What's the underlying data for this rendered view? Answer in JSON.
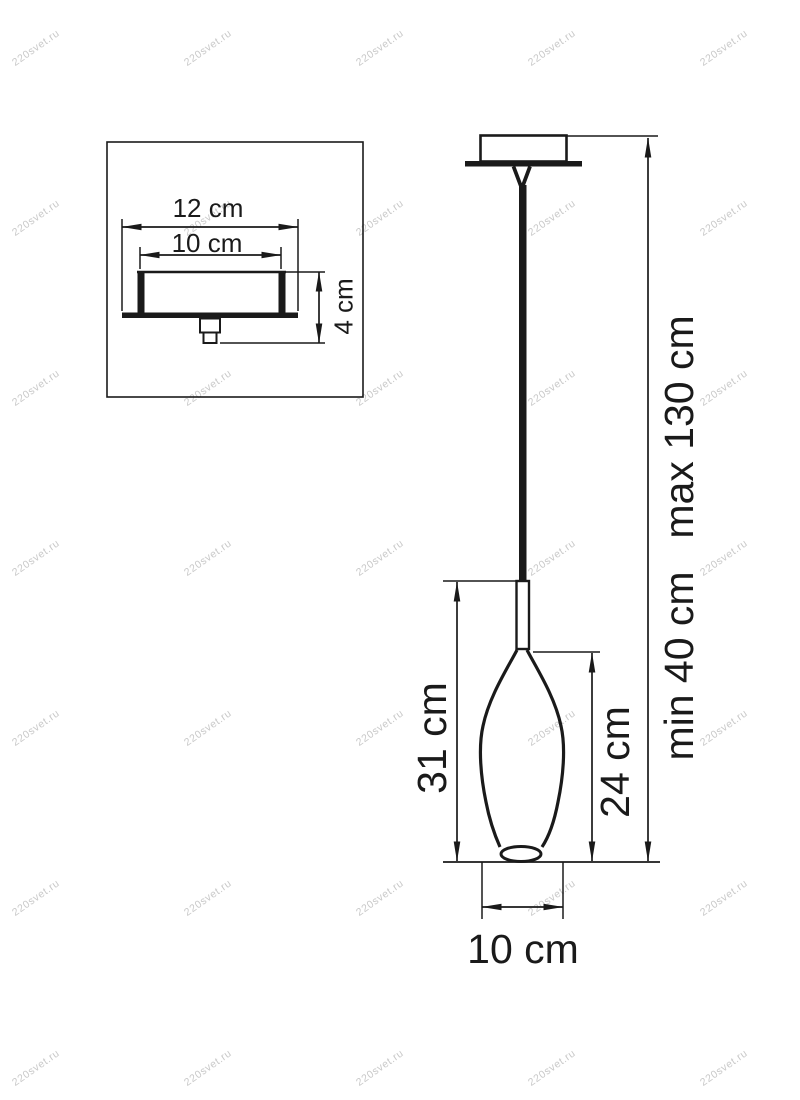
{
  "watermark": {
    "text": "220svet.ru",
    "color": "#c9c9c9"
  },
  "colors": {
    "line": "#1a1a1a",
    "background": "#ffffff"
  },
  "canopy_detail": {
    "plate_width_label": "12 cm",
    "cup_width_label": "10 cm",
    "height_label": "4 cm"
  },
  "pendant": {
    "shade_with_stem_height_label": "31 cm",
    "glass_height_label": "24 cm",
    "min_height_label": "min 40 cm",
    "max_height_label": "max 130 cm",
    "shade_diameter_label": "10 cm"
  }
}
